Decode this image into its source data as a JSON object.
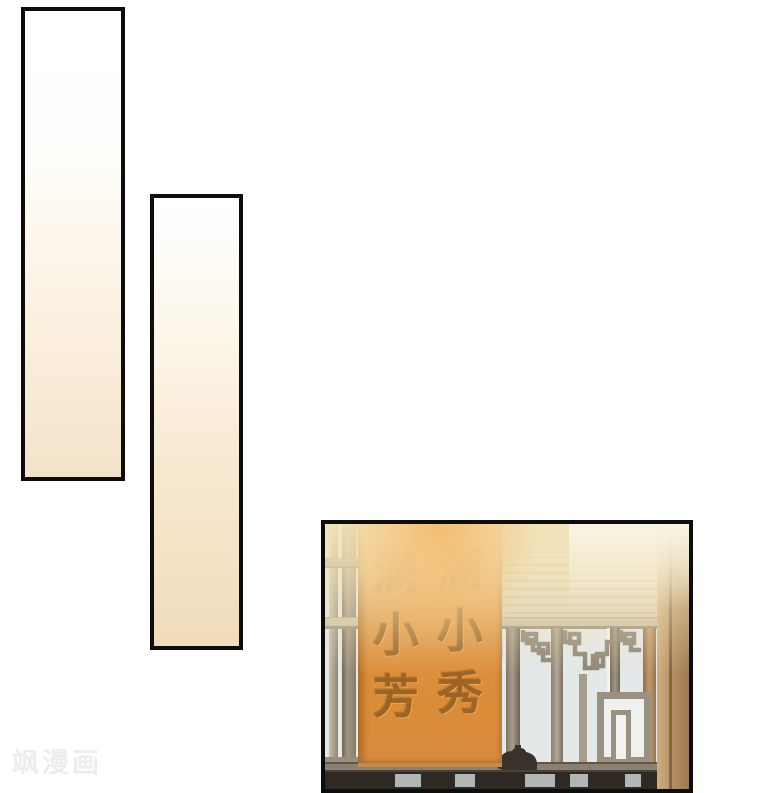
{
  "watermark": {
    "text": "飒漫画",
    "color": "#ededed"
  },
  "panel3": {
    "banner": {
      "left_column": {
        "top": "满",
        "middle": "小",
        "bottom": "芳"
      },
      "right_column": {
        "top": "满",
        "middle": "小",
        "bottom": "秀"
      },
      "bg_color": "#df9240",
      "text_color": "#9c6526"
    }
  },
  "colors": {
    "page_background": "#ffffff",
    "panel_border": "#0d0d0d",
    "empty_panel_gradient_bottom": "#f0dcba",
    "window_pane": "#e3e8e9",
    "wood_frame": "#8f8475",
    "curtain": "#b18c60",
    "light_glare": "#f3e4b9",
    "bottom_silhouette": "#2f2923"
  }
}
